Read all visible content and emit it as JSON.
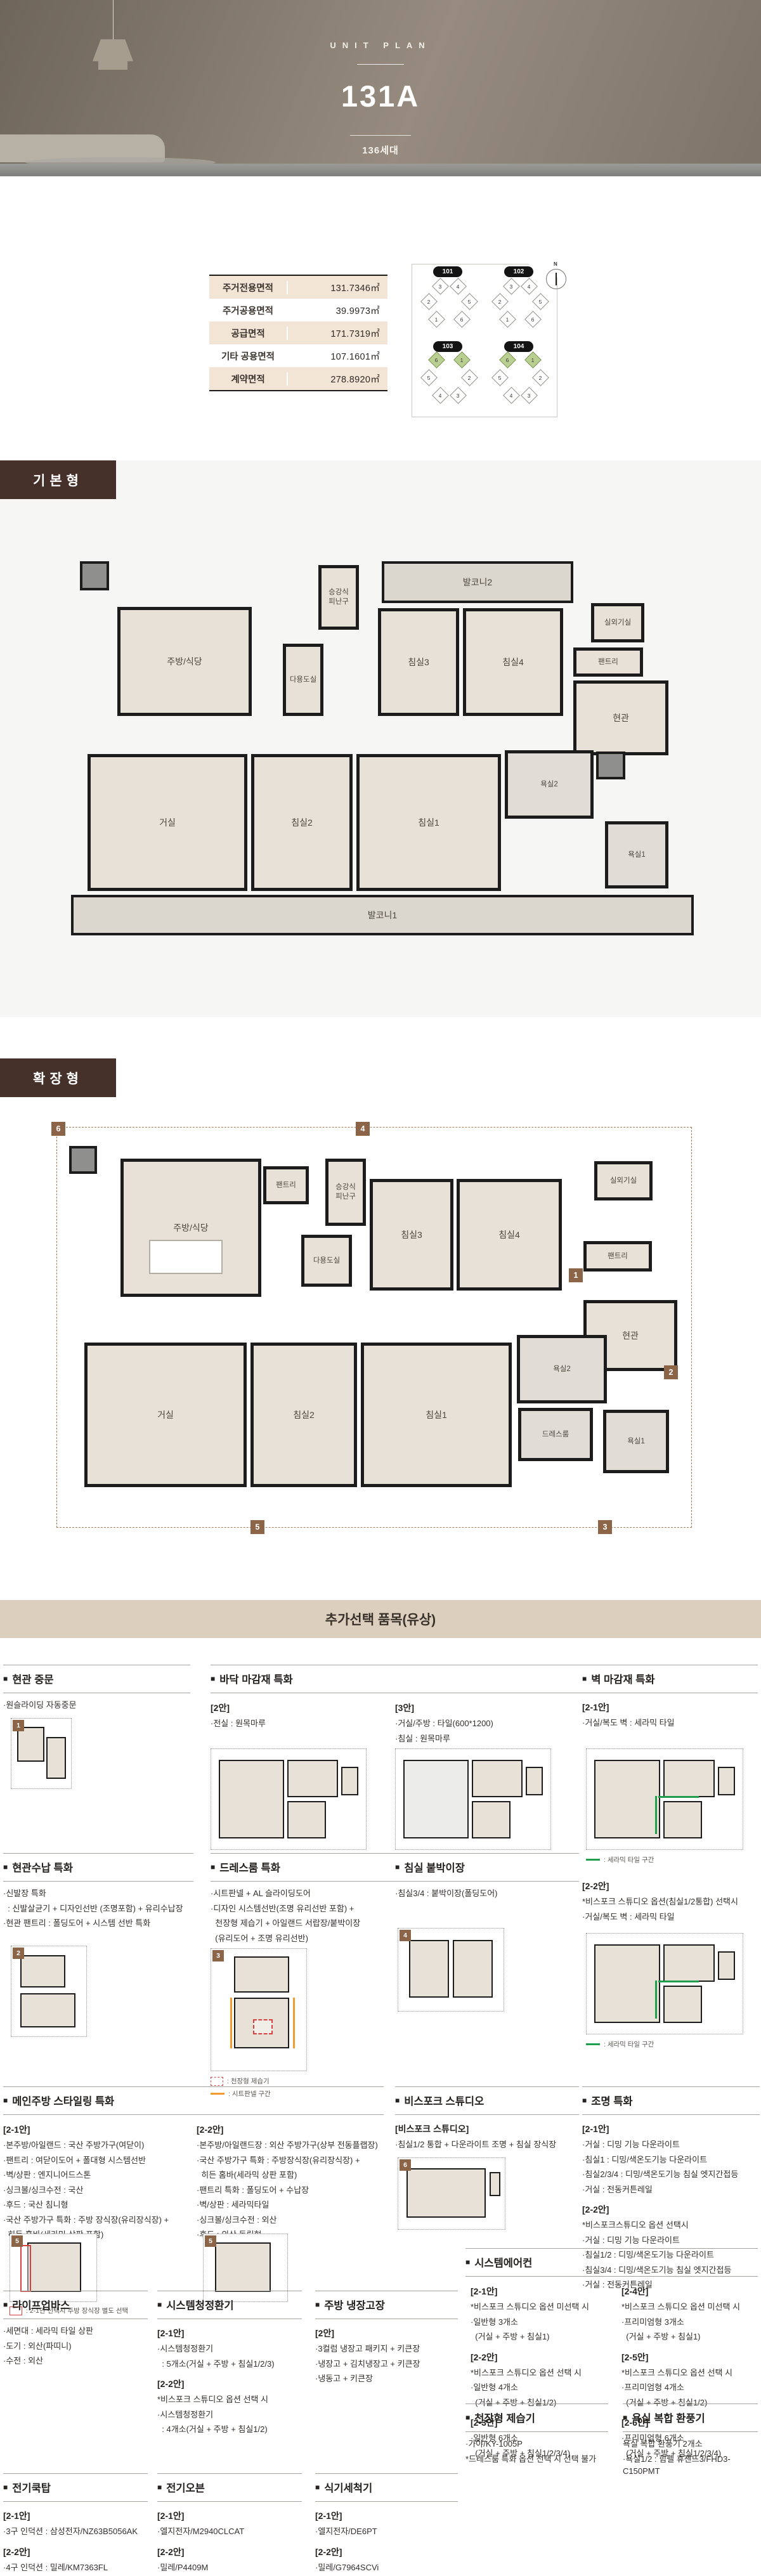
{
  "hero": {
    "eyebrow": "UNIT PLAN",
    "title": "131A",
    "units": "136세대"
  },
  "icons": {
    "square": "■",
    "compass_n": "N"
  },
  "area_table": {
    "rows": [
      {
        "label": "주거전용면적",
        "value": "131.7346㎡"
      },
      {
        "label": "주거공용면적",
        "value": "39.9973㎡"
      },
      {
        "label": "공급면적",
        "value": "171.7319㎡"
      },
      {
        "label": "기타 공용면적",
        "value": "107.1601㎡"
      },
      {
        "label": "계약면적",
        "value": "278.8920㎡"
      }
    ]
  },
  "site_map": {
    "buildings": [
      {
        "no": "101",
        "u": [
          "3",
          "4",
          "2",
          "5",
          "1",
          "6"
        ]
      },
      {
        "no": "102",
        "u": [
          "3",
          "4",
          "2",
          "5",
          "1",
          "6"
        ]
      },
      {
        "no": "103",
        "u": [
          "6",
          "1",
          "5",
          "2",
          "4",
          "3"
        ]
      },
      {
        "no": "104",
        "u": [
          "6",
          "1",
          "5",
          "2",
          "4",
          "3"
        ]
      }
    ]
  },
  "sections": {
    "basic": "기본형",
    "extended": "확장형",
    "options_title": "추가선택 품목(유상)"
  },
  "plan_basic": {
    "rooms": {
      "kitchen": "주방/식당",
      "refuge": "승강식\n피난구",
      "utility": "다용도실",
      "balcony2": "발코니2",
      "bed3": "침실3",
      "bed4": "침실4",
      "ac": "실외기실",
      "pantry": "팬트리",
      "entry": "현관",
      "living": "거실",
      "bed2": "침실2",
      "bed1": "침실1",
      "bath2": "욕실2",
      "bath1": "욕실1",
      "balcony1": "발코니1"
    }
  },
  "plan_ext": {
    "rooms": {
      "kitchen": "주방/식당",
      "pantry_k": "팬트리",
      "refuge": "승강식\n피난구",
      "utility": "다용도실",
      "bed3": "침실3",
      "bed4": "침실4",
      "ac": "실외기실",
      "pantry_e": "팬트리",
      "entry": "현관",
      "living": "거실",
      "bed2": "침실2",
      "bed1": "침실1",
      "bath2": "욕실2",
      "dress": "드레스룸",
      "bath1": "욕실1"
    },
    "markers": [
      "6",
      "4",
      "1",
      "2",
      "5",
      "3"
    ]
  },
  "options": {
    "cards": [
      {
        "title": "현관 중문",
        "marker": "1",
        "lines": [
          "·원슬라이딩 자동중문"
        ]
      },
      {
        "title": "바닥 마감재 특화",
        "lines_a": [
          "[2안]",
          "·전실 : 원목마루"
        ],
        "lines_b": [
          "[3안]",
          "·거실/주방 : 타일(600*1200)",
          "·침실 : 원목마루"
        ]
      },
      {
        "title": "벽 마감재 특화",
        "lines": [
          "[2-1안]",
          "·거실/복도 벽 : 세라믹 타일"
        ],
        "legend": ": 세라믹 타일 구간"
      },
      {
        "title": "현관수납 특화",
        "marker": "2",
        "lines": [
          "·신발장 특화",
          "  : 신발살균기 + 디자인선반 (조명포함) + 유리수납장",
          "·현관 팬트리 : 폴딩도어 + 시스템 선반 특화"
        ]
      },
      {
        "title": "드레스룸 특화",
        "marker": "3",
        "lines": [
          "·시트판넬 + AL 슬라이딩도어",
          "·디자인 시스템선반(조명 유리선반 포함) +",
          "  천장형 제습기 + 아일랜드 서랍장/붙박이장",
          "  (유리도어 + 조명 유리선반)"
        ],
        "legend": ": 천장형 제습기",
        "legend2": ": 시트판넬 구간"
      },
      {
        "title": "침실 붙박이장",
        "marker": "4",
        "lines": [
          "·침실3/4 : 붙박이장(폴딩도어)"
        ]
      },
      {
        "lines": [
          "[2-2안]",
          "*비스포크 스튜디오 옵션(침실1/2통합) 선택시",
          "·거실/복도 벽 : 세라믹 타일"
        ],
        "legend": ": 세라믹 타일 구간"
      },
      {
        "title": "메인주방 스타일링 특화",
        "marker": "5",
        "lines_a": [
          "[2-1안]",
          "·본주방/아일랜드 : 국산 주방가구(여닫이)",
          "·팬트리 : 여닫이도어 + 폴대형 시스템선반",
          "·벽/상판 : 엔지니어드스톤",
          "·싱크볼/싱크수전 : 국산",
          "·후드 : 국산 침니형",
          "·국산 주방가구 특화 : 주방 장식장(유리장식장) +",
          "  히든 홈바(세라믹 상판 포함)"
        ],
        "lines_b": [
          "[2-2안]",
          "·본주방/아일랜드장 : 외산 주방가구(상부 전동플랩장)",
          "·국산 주방가구 특화 : 주방장식장(유리장식장) +",
          "  히든 홈바(세라믹 상판 포함)",
          "·팬트리 특화 : 폴딩도어 + 수납장",
          "·벽/상판 : 세라믹타일",
          "·싱크볼/싱크수전 : 외산",
          "·후드 : 외산 독립형"
        ],
        "legend": ": 2-1안 선택시 주방 장식장 별도 선택"
      },
      {
        "title": "비스포크 스튜디오",
        "marker": "6",
        "lines": [
          "[비스포크 스튜디오]",
          "·침실1/2 통합 + 다운라이트 조명 + 침실 장식장"
        ]
      },
      {
        "title": "조명 특화",
        "lines": [
          "[2-1안]",
          "·거실 : 디밍 기능 다운라이트",
          "·침실1 : 디밍/색온도기능 다운라이트",
          "·침실2/3/4 : 디밍/색온도기능 침실 엣지간접등",
          "·거실 : 전동커튼레일",
          "[2-2안]",
          "*비스포크스튜디오 옵션 선택시",
          "·거실 : 디밍 기능 다운라이트",
          "·침실1/2 : 디밍/색온도기능 다운라이트",
          "·침실3/4 : 디밍/색온도기능 침실 엣지간접등",
          "·거실 : 전동커튼레일"
        ]
      },
      {
        "title": "라이프업바스",
        "lines": [
          "·세면대 : 세라믹 타일 상판",
          "·도기 : 외산(파띠니)",
          "·수전 : 외산"
        ]
      },
      {
        "title": "시스템청정환기",
        "lines": [
          "[2-1안]",
          "·시스템청정환기",
          "  : 5개소(거실 + 주방 + 침실1/2/3)",
          "[2-2안]",
          "*비스포크 스튜디오 옵션 선택 시",
          "·시스템청정환기",
          "  : 4개소(거실 + 주방 + 침실1/2)"
        ]
      },
      {
        "title": "주방 냉장고장",
        "lines": [
          "[2안]",
          "·3컬럼 냉장고 패키지 + 키큰장",
          "·냉장고 + 김치냉장고 + 키큰장",
          "·냉동고 + 키큰장"
        ]
      },
      {
        "title": "시스템에어컨",
        "lines_a": [
          "[2-1안]",
          "*비스포크 스튜디오 옵션 미선택 시",
          "·일반형 3개소",
          "  (거실 + 주방 + 침실1)",
          "[2-2안]",
          "*비스포크 스튜디오 옵션 선택 시",
          "·일반형 4개소",
          "  (거실 + 주방 + 침실1/2)",
          "[2-3안]",
          "·일반형 6개소",
          "  (거실 + 주방 + 침실1/2/3/4)"
        ],
        "lines_b": [
          "[2-4안]",
          "*비스포크 스튜디오 옵션 미선택 시",
          "·프리미엄형 3개소",
          "  (거실 + 주방 + 침실1)",
          "[2-5안]",
          "*비스포크 스튜디오 옵션 선택 시",
          "·프리미엄형 4개소",
          "  (거실 + 주방 + 침실1/2)",
          "[2-6안]",
          "·프리미엄형 6개소",
          "  (거실 + 주방 + 침실1/2/3/4)"
        ]
      },
      {
        "title": "천장형 제습기",
        "lines": [
          "·가야/KY-1005P",
          "*드레스룸 특화 옵션 선택 시 선택 불가"
        ]
      },
      {
        "title": "욕실 복합 환풍기",
        "lines": [
          "욕실 복합 환풍기 2개소",
          "·욕실1/2 : 힘펠 휴젠뜨3/FHD3-C150PMT"
        ]
      },
      {
        "title": "전기쿡탑",
        "lines": [
          "[2-1안]",
          "·3구 인덕션 : 삼성전자/NZ63B5056AK",
          "[2-2안]",
          "·4구 인덕션 : 밀레/KM7363FL"
        ]
      },
      {
        "title": "전기오븐",
        "lines": [
          "[2-1안]",
          "·엘지전자/M2940CLCAT",
          "[2-2안]",
          "·밀레/P4409M"
        ]
      },
      {
        "title": "식기세척기",
        "lines": [
          "[2-1안]",
          "·엘지전자/DE6PT",
          "[2-2안]",
          "·밀레/G7964SCVi"
        ]
      }
    ]
  }
}
